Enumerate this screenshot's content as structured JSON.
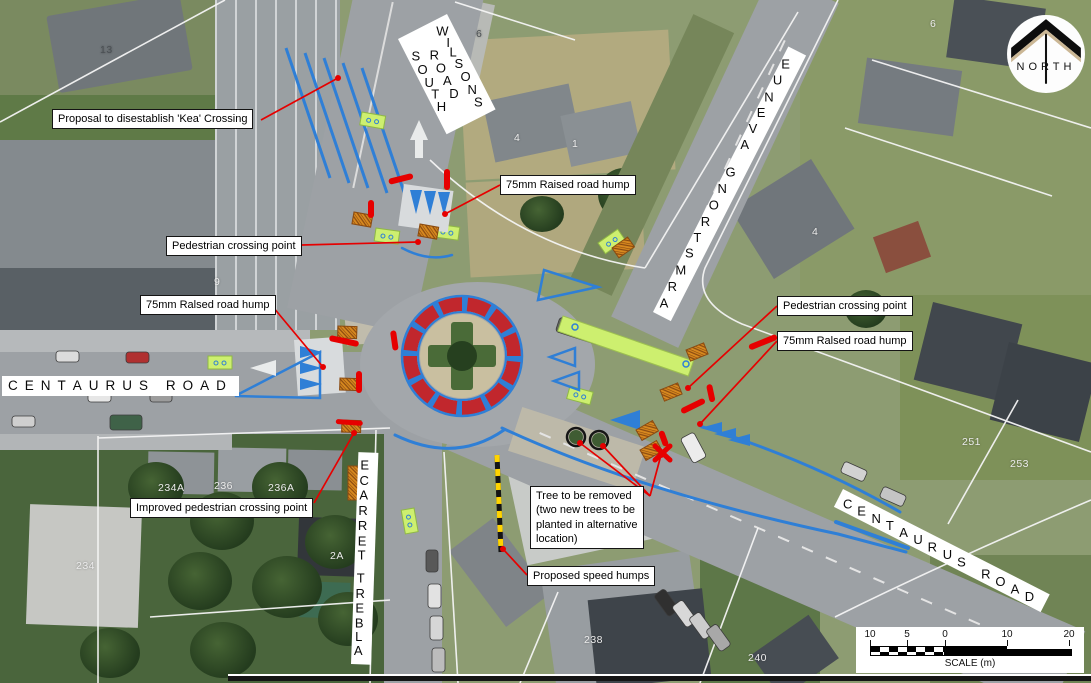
{
  "north": {
    "label": "NORTH"
  },
  "scale_bar": {
    "label": "SCALE (m)",
    "ticks": [
      {
        "label": "10",
        "x": 14
      },
      {
        "label": "5",
        "x": 51
      },
      {
        "label": "0",
        "x": 89
      },
      {
        "label": "10",
        "x": 151
      },
      {
        "label": "20",
        "x": 213
      }
    ]
  },
  "road_labels": [
    {
      "id": "centaurus-road-west",
      "text": "CENTAURUS ROAD",
      "x": 2,
      "y": 376,
      "angle": 0,
      "fs": 13.5,
      "ls": 7
    },
    {
      "id": "wilsons-road-south",
      "lines": [
        "WILSONS",
        "ROAD",
        "SOUTH"
      ],
      "x": 447,
      "y": 14,
      "angle": 63,
      "fs": 13,
      "ls": 5
    },
    {
      "id": "armstrong-avenue",
      "text": "ARMSTRONG AVENUE",
      "x": 653,
      "y": 312,
      "angle": -63,
      "fs": 13,
      "ls": 9
    },
    {
      "id": "centaurus-road-east",
      "text": "CENTAURUS ROAD",
      "x": 843,
      "y": 489,
      "angle": 27,
      "fs": 13,
      "ls": 7
    },
    {
      "id": "albert-terrace",
      "text": "ALBERT TERRACE",
      "x": 351,
      "y": 664,
      "angle": -88,
      "fs": 13,
      "ls": 6
    }
  ],
  "callouts": [
    {
      "id": "kea-crossing",
      "lines": [
        "Proposal to disestablish 'Kea' Crossing"
      ],
      "x": 52,
      "y": 109,
      "leaders": [
        [
          261,
          120,
          338,
          78
        ]
      ]
    },
    {
      "id": "raised-hump-top",
      "lines": [
        "75mm Raised road hump"
      ],
      "x": 500,
      "y": 175,
      "leaders": [
        [
          500,
          185,
          445,
          214
        ]
      ]
    },
    {
      "id": "pedestrian-crossing-left",
      "lines": [
        "Pedestrian crossing point"
      ],
      "x": 166,
      "y": 236,
      "leaders": [
        [
          302,
          245,
          418,
          242
        ]
      ]
    },
    {
      "id": "raised-hump-left",
      "lines": [
        "75mm Ralsed road hump"
      ],
      "x": 140,
      "y": 295,
      "leaders": [
        [
          273,
          307,
          323,
          367
        ]
      ]
    },
    {
      "id": "pedestrian-crossing-right",
      "lines": [
        "Pedestrian crossing point"
      ],
      "x": 777,
      "y": 296,
      "leaders": [
        [
          777,
          306,
          688,
          388
        ]
      ]
    },
    {
      "id": "raised-hump-right",
      "lines": [
        "75mm Ralsed road hump"
      ],
      "x": 777,
      "y": 331,
      "leaders": [
        [
          777,
          341,
          700,
          424
        ]
      ]
    },
    {
      "id": "improved-pedestrian-crossing",
      "lines": [
        "Improved pedestrian crossing point"
      ],
      "x": 130,
      "y": 498,
      "leaders": [
        [
          314,
          503,
          354,
          433
        ]
      ]
    },
    {
      "id": "tree-removed",
      "lines": [
        "Tree to be removed",
        "(two new trees to be",
        "planted in alternative",
        "location)"
      ],
      "x": 530,
      "y": 486,
      "leaders": [
        [
          650,
          496,
          580,
          443
        ],
        [
          650,
          496,
          603,
          446
        ],
        [
          650,
          496,
          661,
          455
        ]
      ]
    },
    {
      "id": "proposed-speed-humps",
      "lines": [
        "Proposed speed humps"
      ],
      "x": 527,
      "y": 566,
      "leaders": [
        [
          527,
          575,
          503,
          549
        ]
      ]
    }
  ],
  "parcel_numbers": [
    {
      "t": "13",
      "x": 100,
      "y": 44,
      "c": "#4b5054"
    },
    {
      "t": "6",
      "x": 476,
      "y": 28,
      "c": "#4b5054"
    },
    {
      "t": "4",
      "x": 514,
      "y": 132,
      "c": "#ececec"
    },
    {
      "t": "1",
      "x": 572,
      "y": 138,
      "c": "#ececec"
    },
    {
      "t": "6",
      "x": 930,
      "y": 18,
      "c": "#ececec"
    },
    {
      "t": "4",
      "x": 812,
      "y": 226,
      "c": "#ececec"
    },
    {
      "t": "9",
      "x": 214,
      "y": 276,
      "c": "#ececec"
    },
    {
      "t": "234A",
      "x": 158,
      "y": 482,
      "c": "#ececec"
    },
    {
      "t": "236",
      "x": 214,
      "y": 480,
      "c": "#ececec"
    },
    {
      "t": "236A",
      "x": 268,
      "y": 482,
      "c": "#ececec"
    },
    {
      "t": "2A",
      "x": 330,
      "y": 550,
      "c": "#ececec"
    },
    {
      "t": "234",
      "x": 76,
      "y": 560,
      "c": "#ececec"
    },
    {
      "t": "238",
      "x": 584,
      "y": 634,
      "c": "#ececec"
    },
    {
      "t": "240",
      "x": 748,
      "y": 652,
      "c": "#ececec"
    },
    {
      "t": "251",
      "x": 962,
      "y": 436,
      "c": "#ececec"
    },
    {
      "t": "253",
      "x": 1010,
      "y": 458,
      "c": "#ececec"
    }
  ],
  "colors": {
    "annotation_red": "#e60000",
    "marking_blue": "#2f7fd6",
    "roundabout_red": "#c1272d",
    "cycle_green": "#cdef6f"
  }
}
